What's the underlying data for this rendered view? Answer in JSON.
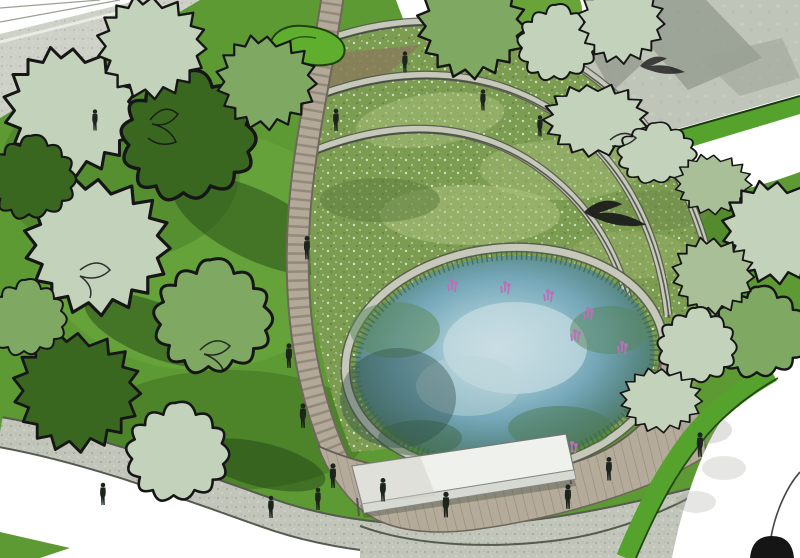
{
  "meta": {
    "title": "Park design rendering — circular wetland pond with terraced rain-garden rings",
    "view": "aerial perspective illustration",
    "style": "hand-drawn ink sketch over watercolor render"
  },
  "colors": {
    "lawn": "#5e9a33",
    "lawn_light": "#79b84a",
    "lawn_dark": "#2f5c1a",
    "shadow_green": "#1e4012",
    "tree_sage": "#c3d2ba",
    "tree_mid": "#7fa963",
    "tree_dark": "#39671f",
    "ink": "#161616",
    "plaza_grey": "#c0c5b9",
    "plaza_shadow": "#8f968a",
    "road_grey": "#cdd1c8",
    "path_white": "#ffffff",
    "gravel": "#c2c6ba",
    "gravel_edge": "#565b4f",
    "boardwalk": "#b2a998",
    "plank_line": "#7a7164",
    "deck_edge": "#6d665b",
    "wall_light": "#c6c9ba",
    "wall_shade": "#3f443b",
    "veg_base": "#7c9c51",
    "veg_light": "#a9bf7b",
    "veg_dark": "#5a7a3e",
    "soil": "#8a7c5c",
    "pond_light": "#cfe0e3",
    "pond_mid": "#74a7b8",
    "pond_deep": "#3f6448",
    "reed": "#3f6a3a",
    "flower_purple": "#bd6fb8",
    "canopy_white": "#eff1ec",
    "canopy_side": "#d7dad2",
    "figure_dark": "#1c241c",
    "bird_black": "#1a1a1a",
    "strip_green": "#55a22c",
    "strip_edge": "#1c3a10"
  },
  "scene": {
    "elements": [
      {
        "name": "central-pond",
        "desc": "circular pond reflecting the sky, ringed by reeds"
      },
      {
        "name": "terrace-walls",
        "desc": "concentric stone retaining walls stepping down to the pond",
        "count": 3
      },
      {
        "name": "terrace-planting",
        "desc": "wildflower and grass terraces between the walls"
      },
      {
        "name": "curved-boardwalk",
        "desc": "timber boardwalk winding along the west side of the pond"
      },
      {
        "name": "timber-deck",
        "desc": "wooden deck platform on the south edge of the pond"
      },
      {
        "name": "bench-canopy",
        "desc": "long white shelter bench on the deck"
      },
      {
        "name": "tree-groves",
        "desc": "sketch-outlined tree canopies over lawns",
        "count": 20
      },
      {
        "name": "lawns",
        "desc": "bright green lawns with cast tree shadows"
      },
      {
        "name": "white-paths",
        "desc": "curving white promenade paths"
      },
      {
        "name": "stone-plaza",
        "desc": "grey paved plaza, top right"
      },
      {
        "name": "gravel-path",
        "desc": "grey gravel path along the bottom"
      },
      {
        "name": "road",
        "desc": "road corner, top left"
      },
      {
        "name": "pedestrians",
        "desc": "small figure silhouettes",
        "count": 17
      },
      {
        "name": "birds",
        "desc": "bird silhouettes in flight",
        "count": 2
      },
      {
        "name": "purple-flowers",
        "desc": "purple loosestrife clusters at the pond edge",
        "count": 8
      },
      {
        "name": "arc-lamp",
        "desc": "sketched arc lamp, bottom right corner"
      },
      {
        "name": "green-mound",
        "desc": "small mounded planting bed, top centre-left"
      }
    ],
    "counts": {
      "pedestrians": 17,
      "birds": 2,
      "terrace_walls": 3,
      "flower_clusters": 8,
      "trees": 20
    }
  }
}
